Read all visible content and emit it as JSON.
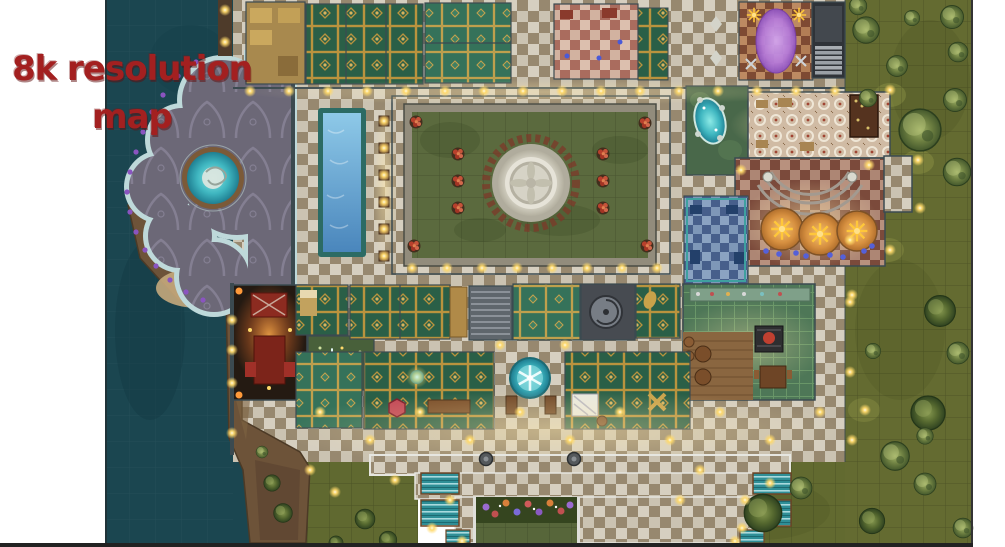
{
  "promo_overlay": {
    "line1": "8k resolution",
    "line2": "map",
    "text_color": "#a32020"
  },
  "map_image": {
    "title": "Top-down fantasy palace battle map",
    "palette": {
      "water": "#1b4650",
      "grass": "#646b31",
      "tile_light": "#d6cfc0",
      "tile_dark": "#97886f",
      "carpet_green": "#2a5f47",
      "carpet_gold": "#b9933e",
      "pool_blue": "#4a86bc",
      "fountain_marble": "#d9d6c8",
      "canopy_orange": "#d79040",
      "rug_purple": "#b57ad9",
      "cliff": "#6d5339",
      "lamp_glow": "#ffd96a",
      "rotunda_floor": "#6c6877"
    },
    "regions": [
      {
        "name": "ocean-water"
      },
      {
        "name": "rotunda-terrace-with-spiral-pool"
      },
      {
        "name": "coastal-cliffs"
      },
      {
        "name": "top-bedroom-wing"
      },
      {
        "name": "purple-lounge"
      },
      {
        "name": "service-stairs"
      },
      {
        "name": "swimming-pool"
      },
      {
        "name": "central-courtyard-fountain"
      },
      {
        "name": "grotto-garden"
      },
      {
        "name": "banquet-hall-with-bar"
      },
      {
        "name": "canopy-stage-hall"
      },
      {
        "name": "blue-tiled-room"
      },
      {
        "name": "kitchen-and-tavern"
      },
      {
        "name": "shrine-room"
      },
      {
        "name": "guest-rooms"
      },
      {
        "name": "mosaic-spa-circle"
      },
      {
        "name": "terraced-south-steps"
      },
      {
        "name": "flower-garden"
      },
      {
        "name": "eastern-grounds-with-trees"
      }
    ]
  }
}
